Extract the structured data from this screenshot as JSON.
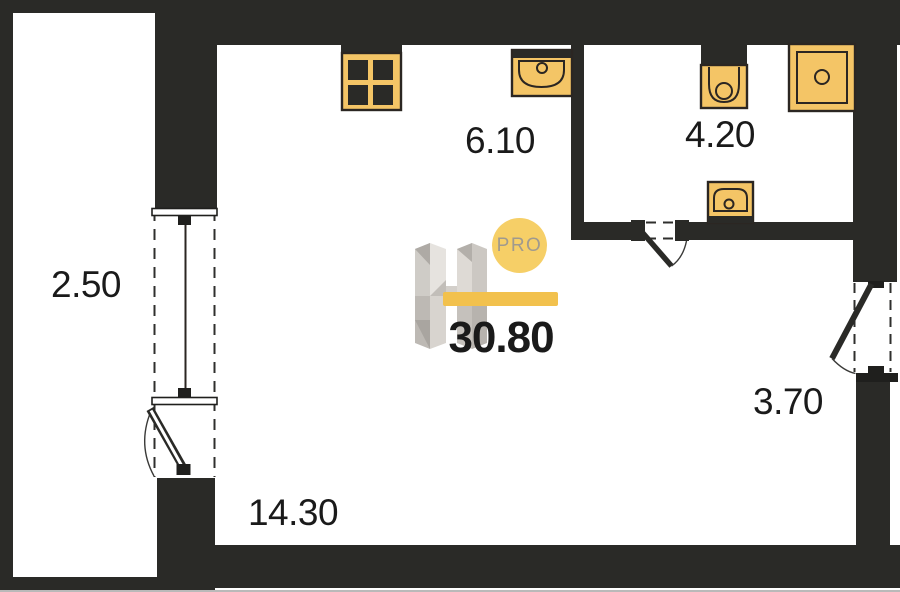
{
  "floorplan": {
    "total_area": "30.80",
    "logo": {
      "brand_letter": "H",
      "badge": "PRO"
    },
    "rooms": [
      {
        "name": "balcony",
        "area": "2.50"
      },
      {
        "name": "kitchen",
        "area": "6.10"
      },
      {
        "name": "bathroom",
        "area": "4.20"
      },
      {
        "name": "hallway",
        "area": "3.70"
      },
      {
        "name": "living-room",
        "area": "14.30"
      }
    ],
    "fixtures": [
      "stove-icon",
      "kitchen-sink-icon",
      "toilet-icon",
      "shower-icon",
      "washbasin-icon"
    ],
    "colors": {
      "wall": "#2a2a27",
      "fixture": "#f4c566",
      "fixtureline": "#2b2622",
      "bar": "#f2c14d",
      "badge": "#f6cf67",
      "text": "#1a1a1a"
    }
  }
}
